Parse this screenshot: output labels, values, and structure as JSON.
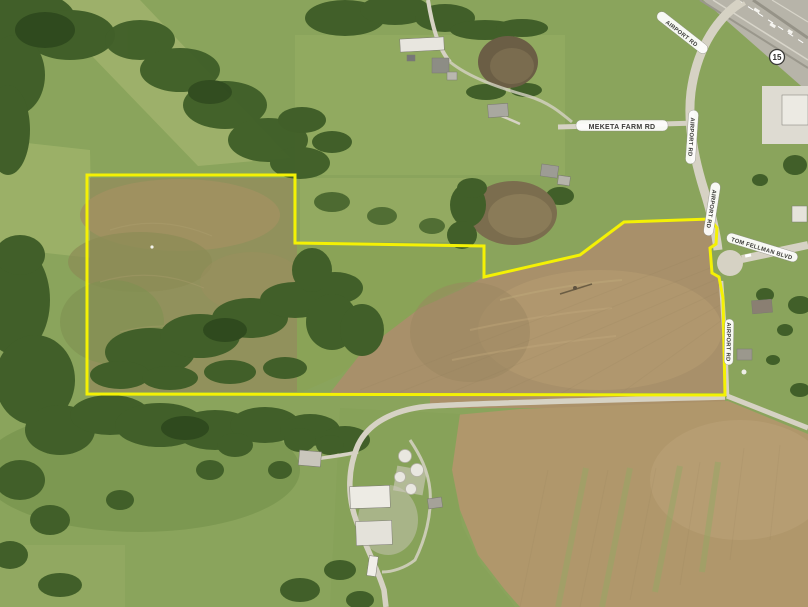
{
  "map": {
    "type": "aerial-property-map",
    "route_shield": {
      "number": "15"
    },
    "labels": {
      "meketa_farm_rd": "MEKETA FARM RD",
      "road_ne_diagonal": "AIRPORT RD",
      "road_ns_upper": "AIRPORT RD",
      "road_ns_mid": "AIRPORT RD",
      "road_lane_lower": "AIRPORT RD",
      "tom_fellman_blvd": "TOM FELLMAN BLVD"
    },
    "boundary": {
      "color": "#f4f104",
      "stroke_width": "3",
      "points": "87,175 295,175 295,243 484,246 484,277 580,255 624,222 710,219 717,228 716,244 710,248 712,273 719,277 723,298 725,395 87,394"
    },
    "palette": {
      "grass_base": "#8aa45c",
      "fallow_field": "#91915c",
      "tilled_field": "#a8906a",
      "tilled_field_lower": "#b0976b",
      "pond_upper": "#6b5e45",
      "pond_lower": "#7b6d4e",
      "road": "#d6d2c4",
      "highway": "#b7b4a9",
      "woods": "#415f29",
      "label_bg": "#ffffff",
      "label_text": "#3b3b38"
    }
  }
}
